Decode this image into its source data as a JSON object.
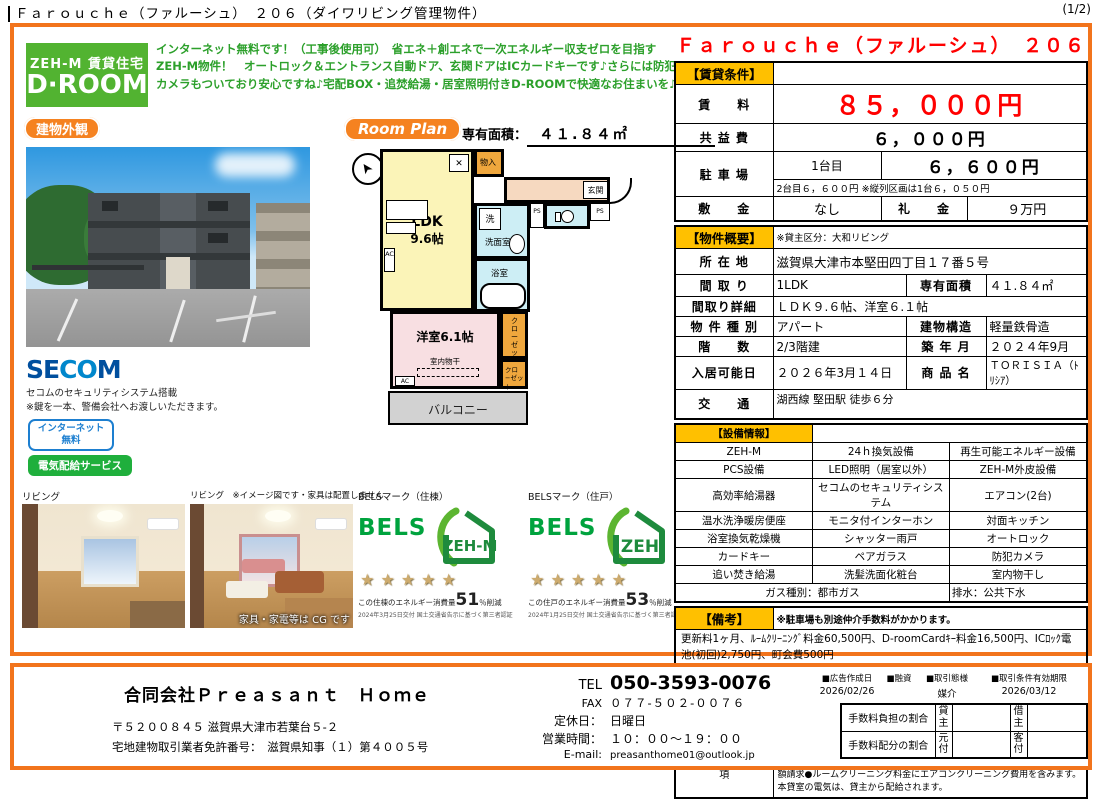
{
  "colors": {
    "accent_orange": "#f2741c",
    "header_yellow": "#ffc000",
    "price_red": "#ff0000",
    "brand_green": "#52b331",
    "desc_green": "#2ca02b",
    "secom_blue": "#0058a8",
    "bels_green": "#00a33e"
  },
  "header": {
    "title": "Ｆａｒｏｕｃｈｅ（ファルーシュ）　２０６（ダイワリビング管理物件）",
    "page": "(1/2)"
  },
  "intro": {
    "logo_top": "ZEH-M 賃貸住宅",
    "logo_main": "D·ROOM",
    "description": "インターネット無料です！（工事後使用可）　省エネ＋創エネで一次エネルギー収支ゼロを目指すZEH-M物件！　オートロック＆エントランス自動ドア、玄関ドアはICカードキーです♪さらには防犯カメラもついており安心ですね♪宅配BOX・追焚給湯・居室照明付きD-ROOMで快適なお住まいを♪"
  },
  "exterior": {
    "badge": "建物外観"
  },
  "secom": {
    "logo_se": "SE",
    "logo_co": "CO",
    "logo_m": "M",
    "note1": "セコムのセキュリティシステム搭載",
    "note2": "※鍵を一本、警備会社へお渡しいただきます。",
    "badge_internet_line1": "インターネット",
    "badge_internet_line2": "無料",
    "badge_electric": "電気配給サービス"
  },
  "floorplan": {
    "badge": "Room Plan",
    "area_label": "専有面積：",
    "area_value": "４１.８４㎡",
    "ldk": "LDK",
    "ldk_size": "9.6帖",
    "bedroom": "洋室6.1帖",
    "wash": "洗面室",
    "wash_symbol": "洗",
    "bath": "浴室",
    "entrance": "玄関",
    "storage": "物入",
    "closet": "クローゼット",
    "closet2": "クロ−ゼット",
    "balcony": "バルコニー",
    "drying": "室内物干",
    "ac": "AC",
    "ps": "PS"
  },
  "photos": {
    "living1_label": "リビング",
    "living2_label": "リビング　※イメージ図です・家具は配置しません",
    "cg_note": "家具・家電等は CG です"
  },
  "bels": {
    "unit_building": {
      "label": "BELSマーク（住棟）",
      "brand": "BELS",
      "zeh": "ZEH-M",
      "stars": "★★★★★",
      "text_prefix": "この住棟のエネルギー消費量",
      "percent": "51",
      "text_suffix": "％削減",
      "cert": "2024年3月25日交付 国土交通省告示に基づく第三者認証"
    },
    "unit_room": {
      "label": "BELSマーク（住戸）",
      "brand": "BELS",
      "zeh": "ZEH",
      "stars": "★★★★★",
      "text_prefix": "この住戸のエネルギー消費量",
      "percent": "53",
      "text_suffix": "％削減",
      "cert": "2024年1月25日交付 国土交通省告示に基づく第三者認証"
    }
  },
  "listing": {
    "title": "Ｆａｒｏｕｃｈｅ（ファルーシュ）　２０６"
  },
  "rental": {
    "section": "【賃貸条件】",
    "rent_label": "賃　　料",
    "rent": "８５，０００円",
    "common_label": "共 益 費",
    "common": "６，０００円",
    "parking_label": "駐 車 場",
    "parking_unit": "1台目",
    "parking": "６，６００円",
    "parking_note": "2台目６，６００円 ※縦列区画は1台６，０５０円",
    "deposit_label": "敷　　金",
    "deposit": "なし",
    "key_label": "礼　　金",
    "key": "９万円"
  },
  "overview": {
    "section": "【物件概要】",
    "owner_note": "※貸主区分：大和リビング",
    "address_label": "所 在 地",
    "address": "滋賀県大津市本堅田四丁目１７番５号",
    "layout_label": "間 取 り",
    "layout": "1LDK",
    "area_label": "専有面積",
    "area": "４１.８４㎡",
    "layout_detail_label": "間取り詳細",
    "layout_detail": "ＬＤＫ９.６帖、洋室６.１帖",
    "type_label": "物 件 種 別",
    "type": "アパート",
    "structure_label": "建物構造",
    "structure": "軽量鉄骨造",
    "floor_label": "階　　数",
    "floor": "2/3階建",
    "built_label": "築 年 月",
    "built": "２０２４年9月",
    "movein_label": "入居可能日",
    "movein": "２０２６年3月１４日",
    "product_label": "商 品 名",
    "product": "ＴＯＲＩＳＩＡ（ﾄﾘｼｱ）",
    "access_label": "交　　通",
    "access": "湖西線 堅田駅 徒歩６分"
  },
  "equipment": {
    "section": "【設備情報】",
    "rows": [
      [
        "ZEH-M",
        "24ｈ換気設備",
        "再生可能エネルギー設備"
      ],
      [
        "PCS設備",
        "LED照明（居室以外）",
        "ZEH-M外皮設備"
      ],
      [
        "高効率給湯器",
        "セコムのセキュリティシステム",
        "エアコン(2台)"
      ],
      [
        "温水洗浄暖房便座",
        "モニタ付インターホン",
        "対面キッチン"
      ],
      [
        "浴室換気乾燥機",
        "シャッター雨戸",
        "オートロック"
      ],
      [
        "カードキー",
        "ペアガラス",
        "防犯カメラ"
      ],
      [
        "追い焚き給湯",
        "洗髪洗面化粧台",
        "室内物干し"
      ]
    ],
    "gas": "ガス種別：都市ガス",
    "drain": "排水：公共下水"
  },
  "remarks": {
    "section": "【備考】",
    "note": "※駐車場も別途仲介手数料がかかります。",
    "renewal": "更新料1ヶ月、ﾙｰﾑｸﾘｰﾆﾝｸﾞ料金60,500円、D-roomCardｷｰ料金16,500円、ICﾛｯｸ電池(初回)2,750円、町会費500円",
    "brokerage_label": "仲介手数料",
    "brokerage": "1.10ヶ月",
    "insurance_label": "保険",
    "insurance": "有り　家財保険加入の必要があります。",
    "caution_label": "注意事項",
    "caution": "機関保証加入必須。初回保証料３５０００円、月額保証料賃料等総額の１％＋８００円/月(その他商品あり)　●６５歳以上の方の契約は定期借家契約（２年再契約型）となります。機関保証の加入が必須となります。（初回保証料：月額賃料等合計額×１００%,更新：２万円／１年）本物件はＺＥＨ-Ｍ物件です。詳細はＺＥＨ-Ｍ情報をご確認ください。　●町会費は月額請求●ルームクリーニング料金にエアコンクリーニング費用を含みます。　本貸室の電気は、貸主から配給されます。"
  },
  "footer": {
    "company": "合同会社Ｐｒｅａｓａｎｔ　Ｈｏｍｅ",
    "postal_address": "〒５２００８４５ 滋賀県大津市若葉台５-２",
    "license": "宅地建物取引業者免許番号：　滋賀県知事（１）第４００５号",
    "tel_label": "TEL",
    "tel": "050-3593-0076",
    "fax_label": "FAX",
    "fax": "０７７-５０２-００７６",
    "holiday_label": "定休日：",
    "holiday": "日曜日",
    "hours_label": "営業時間：",
    "hours": "１０：００～１９：００",
    "email_label": "E-mail:",
    "email": "preasanthome01@outlook.jp",
    "ad_date_label": "■広告作成日",
    "ad_date": "2026/02/26",
    "loan_label": "■融資",
    "deal_type_label": "■取引態様",
    "deal_type": "媒介",
    "valid_label": "■取引条件有効期限",
    "valid": "2026/03/12",
    "fee_burden_label": "手数料負担の割合",
    "fee_split_label": "手数料配分の割合",
    "lessor": "貸主",
    "lessee": "借主",
    "agent_owner": "元付",
    "agent_client": "客付"
  }
}
